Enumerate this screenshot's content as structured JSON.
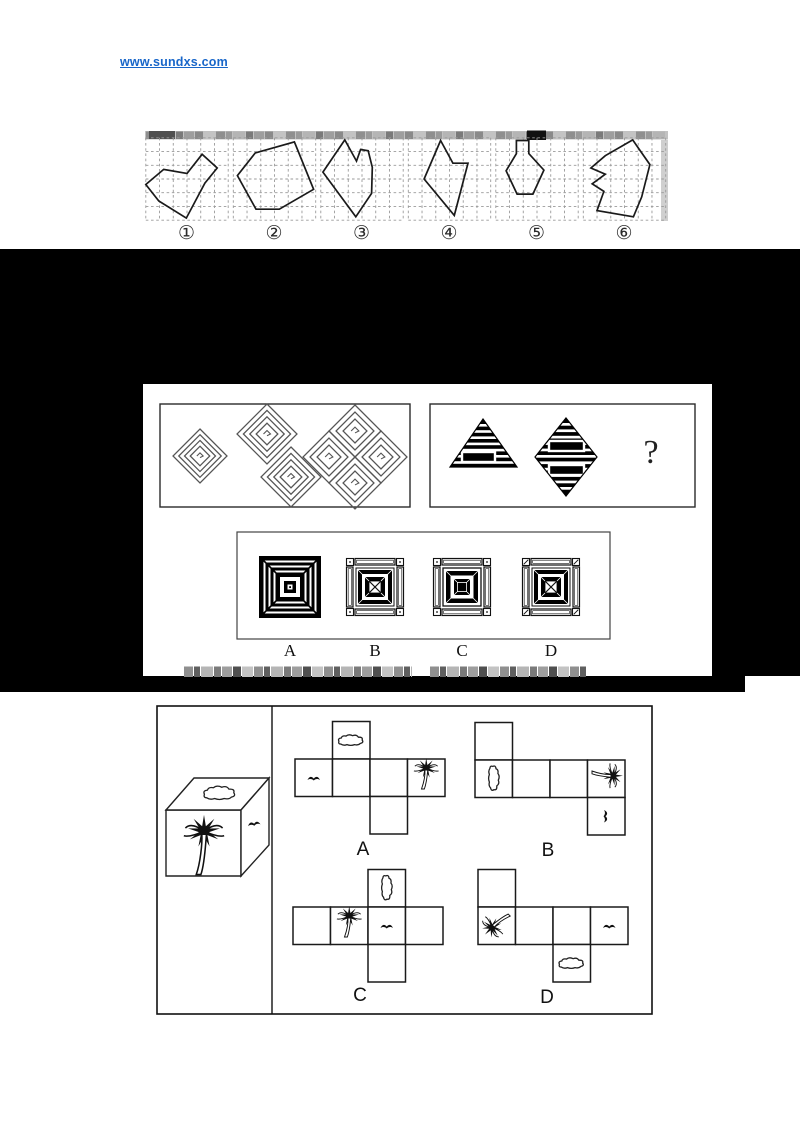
{
  "header": {
    "link_text": "www.sundxs.com"
  },
  "figure_strip": {
    "labels": [
      "①",
      "②",
      "③",
      "④",
      "⑤",
      "⑥"
    ],
    "grid_cols": 6,
    "grid_rows": 6,
    "polygons": [
      [
        [
          0,
          3.4
        ],
        [
          1.3,
          2.3
        ],
        [
          3.0,
          2.6
        ],
        [
          4.1,
          1.2
        ],
        [
          5.2,
          2.2
        ],
        [
          4.3,
          3.3
        ],
        [
          2.95,
          5.85
        ],
        [
          0.95,
          4.6
        ]
      ],
      [
        [
          1.6,
          1.1
        ],
        [
          4.45,
          0.3
        ],
        [
          5.85,
          3.75
        ],
        [
          3.35,
          5.2
        ],
        [
          1.65,
          5.2
        ],
        [
          0.3,
          2.75
        ]
      ],
      [
        [
          1.75,
          0.15
        ],
        [
          2.6,
          1.7
        ],
        [
          2.9,
          0.85
        ],
        [
          3.45,
          0.95
        ],
        [
          3.75,
          2.15
        ],
        [
          3.7,
          4.05
        ],
        [
          2.55,
          5.75
        ],
        [
          0.15,
          2.5
        ]
      ],
      [
        [
          2.35,
          0.2
        ],
        [
          3.25,
          1.85
        ],
        [
          4.35,
          1.85
        ],
        [
          3.35,
          5.65
        ],
        [
          1.15,
          3.0
        ]
      ],
      [
        [
          1.5,
          0.2
        ],
        [
          2.4,
          0.2
        ],
        [
          2.4,
          1.15
        ],
        [
          3.5,
          2.35
        ],
        [
          2.7,
          4.1
        ],
        [
          1.55,
          4.1
        ],
        [
          0.75,
          2.4
        ],
        [
          1.5,
          1.15
        ]
      ],
      [
        [
          3.6,
          0.15
        ],
        [
          4.85,
          1.95
        ],
        [
          4.25,
          4.3
        ],
        [
          3.65,
          5.75
        ],
        [
          1.0,
          5.3
        ],
        [
          1.5,
          3.9
        ],
        [
          0.65,
          3.35
        ],
        [
          1.6,
          2.65
        ],
        [
          0.55,
          2.2
        ],
        [
          1.6,
          1.3
        ]
      ]
    ]
  },
  "example_panel": {
    "question_mark": "?",
    "left_mazes": [
      {
        "cx": 200,
        "cy": 456,
        "half": 27,
        "rings": 4
      },
      {
        "cx": 267,
        "cy": 434,
        "half": 30,
        "rings": 4
      },
      {
        "cx": 291,
        "cy": 477,
        "half": 30,
        "rings": 4
      },
      {
        "cx": 355,
        "cy": 431,
        "half": 26,
        "rings": 3
      },
      {
        "cx": 329,
        "cy": 457,
        "half": 26,
        "rings": 3
      },
      {
        "cx": 381,
        "cy": 457,
        "half": 26,
        "rings": 3
      },
      {
        "cx": 355,
        "cy": 483,
        "half": 26,
        "rings": 3
      }
    ],
    "right_figures": [
      "striped-triangle",
      "striped-diamond",
      "question-mark"
    ]
  },
  "options_panel": {
    "letters": [
      "A",
      "B",
      "C",
      "D"
    ],
    "tile_styles": [
      "black-bullseye",
      "frame-xbox-dot",
      "frame-solidcenter-dot",
      "frame-xbox-slash"
    ]
  },
  "cube_question": {
    "cube_faces": {
      "top": "cloud",
      "front": "palm-tree",
      "right": "bird"
    },
    "nets": [
      {
        "label": "A",
        "origin": [
          295,
          759
        ],
        "cells": [
          {
            "g": [
              1,
              -1
            ],
            "icon": "cloud",
            "rot": 0
          },
          {
            "g": [
              0,
              0
            ],
            "icon": "bird",
            "rot": 0
          },
          {
            "g": [
              1,
              0
            ]
          },
          {
            "g": [
              2,
              0
            ]
          },
          {
            "g": [
              3,
              0
            ],
            "icon": "palm",
            "rot": 0
          },
          {
            "g": [
              2,
              1
            ]
          }
        ]
      },
      {
        "label": "B",
        "origin": [
          475,
          760
        ],
        "cells": [
          {
            "g": [
              0,
              -1
            ]
          },
          {
            "g": [
              0,
              0
            ],
            "icon": "cloud",
            "rot": 90
          },
          {
            "g": [
              1,
              0
            ]
          },
          {
            "g": [
              2,
              0
            ]
          },
          {
            "g": [
              3,
              0
            ],
            "icon": "palm",
            "rot": 90
          },
          {
            "g": [
              3,
              1
            ],
            "icon": "bird",
            "rot": 90
          }
        ]
      },
      {
        "label": "C",
        "origin": [
          293,
          907
        ],
        "cells": [
          {
            "g": [
              2,
              -1
            ],
            "icon": "cloud",
            "rot": 90
          },
          {
            "g": [
              0,
              0
            ]
          },
          {
            "g": [
              1,
              0
            ],
            "icon": "palm",
            "rot": 0
          },
          {
            "g": [
              2,
              0
            ],
            "icon": "bird",
            "rot": 0
          },
          {
            "g": [
              3,
              0
            ]
          },
          {
            "g": [
              2,
              1
            ]
          }
        ]
      },
      {
        "label": "D",
        "origin": [
          478,
          907
        ],
        "cells": [
          {
            "g": [
              0,
              -1
            ]
          },
          {
            "g": [
              0,
              0
            ],
            "icon": "palm",
            "rot": -135
          },
          {
            "g": [
              1,
              0
            ]
          },
          {
            "g": [
              2,
              0
            ]
          },
          {
            "g": [
              3,
              0
            ],
            "icon": "bird",
            "rot": 0
          },
          {
            "g": [
              2,
              1
            ],
            "icon": "cloud",
            "rot": 0
          }
        ]
      }
    ]
  }
}
